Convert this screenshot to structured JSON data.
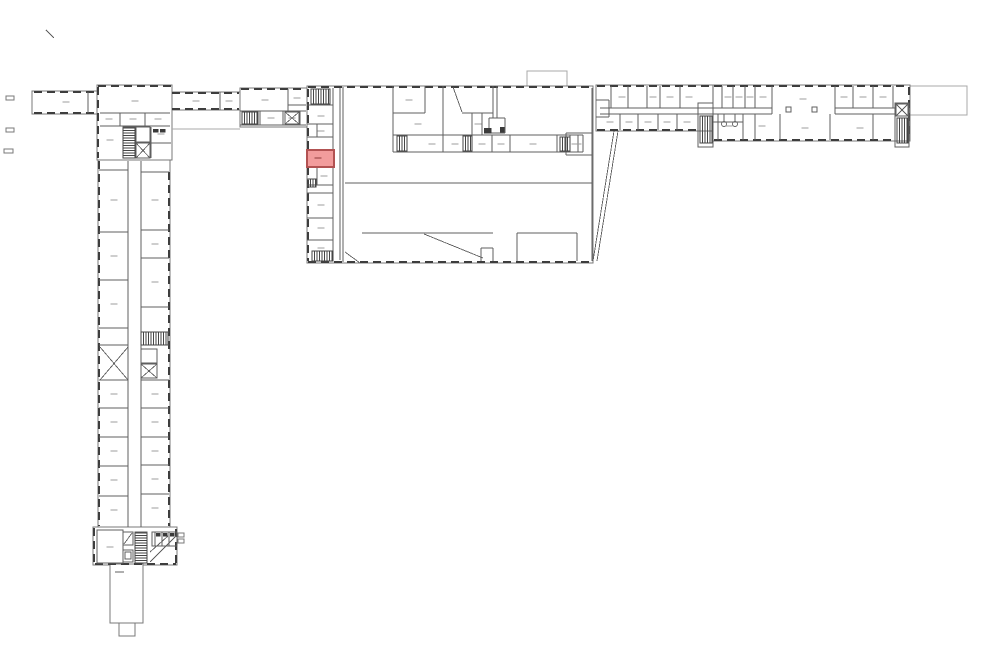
{
  "canvas": {
    "width": 1000,
    "height": 666,
    "background": "#ffffff"
  },
  "colors": {
    "envelope": "#787878",
    "wall": "#5f5f5f",
    "window": "#3d3d3d",
    "thin": "#a8a8a8",
    "hatch": "#454545",
    "label": "#9e9e9e",
    "dark": "#3a3a3a",
    "highlight_fill": "#F29C9C",
    "highlight_stroke": "#B25252",
    "highlight_label": "#8f3a3a"
  },
  "plan": {
    "envelopes": [
      [
        527,
        71,
        40,
        16,
        1
      ],
      [
        910,
        86,
        57,
        29,
        1
      ],
      [
        32,
        91,
        65,
        23,
        0
      ],
      [
        97,
        85,
        75,
        75,
        0
      ],
      [
        172,
        92,
        68,
        18,
        0
      ],
      [
        240,
        88,
        67,
        39,
        0
      ],
      [
        307,
        86,
        286,
        177,
        0
      ],
      [
        596,
        85,
        117,
        46,
        0
      ],
      [
        713,
        85,
        197,
        56,
        0
      ],
      [
        98,
        160,
        72,
        368,
        0
      ],
      [
        93,
        527,
        84,
        38,
        0
      ],
      [
        110,
        564,
        33,
        59,
        2
      ],
      [
        119,
        623,
        16,
        13,
        2
      ]
    ],
    "windows": [
      [
        34,
        92,
        95,
        92
      ],
      [
        34,
        113,
        95,
        113
      ],
      [
        98,
        87,
        98,
        158
      ],
      [
        98,
        86,
        171,
        86
      ],
      [
        172,
        93,
        239,
        93
      ],
      [
        172,
        109,
        239,
        109
      ],
      [
        241,
        89,
        306,
        89
      ],
      [
        308,
        87,
        592,
        87
      ],
      [
        308,
        262,
        592,
        262
      ],
      [
        308,
        89,
        308,
        261
      ],
      [
        597,
        86,
        909,
        86
      ],
      [
        597,
        130,
        697,
        130
      ],
      [
        714,
        140,
        894,
        140
      ],
      [
        909,
        87,
        909,
        139
      ],
      [
        99,
        161,
        99,
        526
      ],
      [
        169,
        172,
        169,
        526
      ],
      [
        94,
        528,
        94,
        564
      ],
      [
        95,
        564,
        176,
        564
      ],
      [
        176,
        529,
        176,
        563
      ]
    ],
    "walls": [
      [
        88,
        92,
        88,
        113
      ],
      [
        100,
        113,
        170,
        113
      ],
      [
        100,
        126,
        170,
        126
      ],
      [
        120,
        113,
        120,
        126
      ],
      [
        145,
        113,
        145,
        126
      ],
      [
        151,
        127,
        151,
        158
      ],
      [
        151,
        143,
        171,
        143
      ],
      [
        220,
        92,
        220,
        110
      ],
      [
        240,
        111,
        306,
        111
      ],
      [
        288,
        89,
        288,
        111
      ],
      [
        288,
        105,
        306,
        105
      ],
      [
        240,
        125,
        306,
        125
      ],
      [
        260,
        111,
        260,
        125
      ],
      [
        283,
        111,
        283,
        125
      ],
      [
        300,
        111,
        300,
        125
      ],
      [
        333,
        88,
        333,
        260
      ],
      [
        340,
        88,
        340,
        260
      ],
      [
        343,
        87,
        343,
        262
      ],
      [
        307,
        105,
        333,
        105
      ],
      [
        307,
        124,
        333,
        124
      ],
      [
        307,
        137,
        333,
        137
      ],
      [
        307,
        185,
        333,
        185
      ],
      [
        307,
        193,
        333,
        193
      ],
      [
        307,
        218,
        333,
        218
      ],
      [
        307,
        240,
        333,
        240
      ],
      [
        317,
        124,
        317,
        137
      ],
      [
        317,
        167,
        317,
        185
      ],
      [
        393,
        86,
        393,
        152
      ],
      [
        393,
        113,
        425,
        113
      ],
      [
        425,
        86,
        425,
        113
      ],
      [
        443,
        86,
        443,
        135
      ],
      [
        393,
        135,
        583,
        135
      ],
      [
        393,
        152,
        583,
        152
      ],
      [
        583,
        135,
        583,
        152
      ],
      [
        407,
        135,
        407,
        152
      ],
      [
        443,
        135,
        443,
        152
      ],
      [
        463,
        135,
        463,
        152
      ],
      [
        472,
        135,
        472,
        152
      ],
      [
        492,
        135,
        492,
        152
      ],
      [
        510,
        135,
        510,
        152
      ],
      [
        557,
        135,
        557,
        152
      ],
      [
        570,
        135,
        570,
        152
      ],
      [
        578,
        135,
        578,
        152
      ],
      [
        462,
        113,
        493,
        113
      ],
      [
        472,
        113,
        472,
        135
      ],
      [
        482,
        113,
        482,
        135
      ],
      [
        493,
        86,
        493,
        118
      ],
      [
        497,
        86,
        497,
        118
      ],
      [
        489,
        118,
        505,
        118
      ],
      [
        489,
        118,
        489,
        133
      ],
      [
        505,
        118,
        505,
        133
      ],
      [
        489,
        133,
        505,
        133
      ],
      [
        345,
        183,
        592,
        183
      ],
      [
        566,
        133,
        592,
        133
      ],
      [
        566,
        133,
        566,
        155
      ],
      [
        566,
        155,
        592,
        155
      ],
      [
        592,
        88,
        592,
        261
      ],
      [
        362,
        233,
        493,
        233
      ],
      [
        517,
        233,
        577,
        233
      ],
      [
        517,
        233,
        517,
        261
      ],
      [
        577,
        233,
        577,
        261
      ],
      [
        481,
        248,
        493,
        248
      ],
      [
        481,
        248,
        481,
        261
      ],
      [
        493,
        248,
        493,
        261
      ],
      [
        600,
        108,
        772,
        108
      ],
      [
        600,
        114,
        772,
        114
      ],
      [
        835,
        108,
        895,
        108
      ],
      [
        835,
        114,
        895,
        114
      ],
      [
        611,
        86,
        611,
        108
      ],
      [
        628,
        86,
        628,
        108
      ],
      [
        647,
        86,
        647,
        108
      ],
      [
        660,
        86,
        660,
        108
      ],
      [
        680,
        86,
        680,
        108
      ],
      [
        713,
        86,
        713,
        108
      ],
      [
        722,
        86,
        722,
        108
      ],
      [
        733,
        86,
        733,
        108
      ],
      [
        745,
        86,
        745,
        108
      ],
      [
        755,
        86,
        755,
        108
      ],
      [
        772,
        86,
        772,
        114
      ],
      [
        835,
        86,
        835,
        114
      ],
      [
        853,
        86,
        853,
        108
      ],
      [
        873,
        86,
        873,
        108
      ],
      [
        893,
        86,
        893,
        108
      ],
      [
        620,
        114,
        620,
        130
      ],
      [
        638,
        114,
        638,
        130
      ],
      [
        658,
        114,
        658,
        130
      ],
      [
        677,
        114,
        677,
        130
      ],
      [
        718,
        114,
        718,
        140
      ],
      [
        743,
        114,
        743,
        140
      ],
      [
        755,
        114,
        755,
        140
      ],
      [
        780,
        114,
        780,
        140
      ],
      [
        830,
        114,
        830,
        140
      ],
      [
        873,
        114,
        873,
        140
      ],
      [
        596,
        100,
        609,
        100
      ],
      [
        609,
        100,
        609,
        117
      ],
      [
        596,
        117,
        609,
        117
      ],
      [
        724,
        114,
        724,
        122
      ],
      [
        735,
        114,
        735,
        122
      ],
      [
        713,
        122,
        743,
        122
      ],
      [
        128,
        161,
        128,
        527
      ],
      [
        141,
        161,
        141,
        527
      ],
      [
        99,
        170,
        128,
        170
      ],
      [
        99,
        232,
        128,
        232
      ],
      [
        99,
        280,
        128,
        280
      ],
      [
        99,
        328,
        128,
        328
      ],
      [
        99,
        345,
        128,
        345
      ],
      [
        99,
        380,
        128,
        380
      ],
      [
        99,
        408,
        128,
        408
      ],
      [
        99,
        437,
        128,
        437
      ],
      [
        99,
        466,
        128,
        466
      ],
      [
        99,
        496,
        128,
        496
      ],
      [
        141,
        172,
        169,
        172
      ],
      [
        141,
        230,
        169,
        230
      ],
      [
        141,
        258,
        169,
        258
      ],
      [
        141,
        307,
        169,
        307
      ],
      [
        141,
        332,
        169,
        332
      ],
      [
        141,
        345,
        169,
        345
      ],
      [
        141,
        380,
        169,
        380
      ],
      [
        141,
        408,
        169,
        408
      ],
      [
        141,
        437,
        169,
        437
      ],
      [
        141,
        465,
        169,
        465
      ],
      [
        141,
        494,
        169,
        494
      ],
      [
        155,
        532,
        155,
        546
      ],
      [
        162,
        532,
        162,
        546
      ],
      [
        169,
        532,
        169,
        546
      ],
      [
        152,
        546,
        177,
        546
      ],
      [
        115,
        572,
        124,
        572
      ]
    ],
    "thin": [
      [
        172,
        129,
        240,
        129
      ]
    ],
    "boxes": [
      [
        123,
        127,
        12,
        31
      ],
      [
        136,
        127,
        14,
        15
      ],
      [
        97,
        530,
        26,
        33
      ],
      [
        123,
        532,
        10,
        13
      ],
      [
        123,
        550,
        10,
        12
      ],
      [
        125,
        552,
        6,
        7
      ],
      [
        135,
        532,
        12,
        31
      ],
      [
        152,
        532,
        25,
        14
      ],
      [
        786,
        107,
        5,
        5
      ],
      [
        812,
        107,
        5,
        5
      ],
      [
        141,
        349,
        16,
        14
      ],
      [
        698,
        103,
        15,
        44
      ],
      [
        895,
        103,
        14,
        44
      ]
    ],
    "hatches": [
      [
        123,
        128,
        12,
        30,
        "h"
      ],
      [
        242,
        112,
        16,
        12,
        "v"
      ],
      [
        311,
        89,
        19,
        15,
        "v"
      ],
      [
        308,
        179,
        8,
        8,
        "v"
      ],
      [
        312,
        251,
        21,
        10,
        "v"
      ],
      [
        397,
        136,
        10,
        15,
        "v"
      ],
      [
        463,
        136,
        9,
        15,
        "v"
      ],
      [
        560,
        137,
        10,
        14,
        "v"
      ],
      [
        700,
        116,
        12,
        27,
        "v"
      ],
      [
        897,
        118,
        11,
        25,
        "v"
      ],
      [
        141,
        332,
        27,
        13,
        "v"
      ],
      [
        135,
        533,
        12,
        30,
        "h"
      ]
    ],
    "xboxes": [
      [
        136,
        143,
        14,
        15
      ],
      [
        285,
        112,
        14,
        12
      ],
      [
        896,
        104,
        12,
        12
      ],
      [
        141,
        364,
        16,
        14
      ]
    ],
    "diagonals": [
      [
        424,
        234,
        483,
        258
      ],
      [
        345,
        252,
        360,
        263
      ],
      [
        614,
        131,
        593,
        261
      ],
      [
        618,
        131,
        597,
        261
      ],
      [
        453,
        87,
        462,
        112
      ],
      [
        100,
        347,
        128,
        380
      ],
      [
        128,
        347,
        100,
        380
      ],
      [
        124,
        544,
        132,
        533
      ],
      [
        150,
        562,
        176,
        536
      ],
      [
        150,
        552,
        168,
        536
      ],
      [
        46,
        30,
        54,
        38
      ]
    ],
    "darks": [
      [
        500,
        127,
        4,
        5
      ],
      [
        484,
        128,
        7,
        5
      ],
      [
        156,
        533,
        4,
        3
      ],
      [
        163,
        533,
        4,
        3
      ],
      [
        170,
        533,
        4,
        3
      ],
      [
        153,
        129,
        5,
        3
      ],
      [
        160,
        129,
        5,
        3
      ]
    ],
    "circles": [
      [
        724,
        124,
        2.5
      ],
      [
        735,
        124,
        2.5
      ]
    ],
    "marks": [
      [
        6,
        96,
        8,
        4
      ],
      [
        6,
        128,
        8,
        4
      ],
      [
        4,
        149,
        9,
        4
      ],
      [
        178,
        533,
        6,
        4
      ],
      [
        178,
        539,
        6,
        4
      ]
    ],
    "labels": [
      [
        66,
        102
      ],
      [
        135,
        101
      ],
      [
        109,
        119
      ],
      [
        133,
        119
      ],
      [
        158,
        119
      ],
      [
        110,
        140
      ],
      [
        161,
        134
      ],
      [
        196,
        101
      ],
      [
        229,
        101
      ],
      [
        265,
        100
      ],
      [
        297,
        98
      ],
      [
        271,
        118
      ],
      [
        292,
        118
      ],
      [
        321,
        116
      ],
      [
        321,
        131
      ],
      [
        324,
        176
      ],
      [
        321,
        205
      ],
      [
        321,
        228
      ],
      [
        321,
        248
      ],
      [
        409,
        100
      ],
      [
        418,
        124
      ],
      [
        478,
        124
      ],
      [
        432,
        144
      ],
      [
        455,
        144
      ],
      [
        482,
        144
      ],
      [
        501,
        144
      ],
      [
        533,
        144
      ],
      [
        575,
        144
      ],
      [
        578,
        144
      ],
      [
        622,
        97
      ],
      [
        653,
        97
      ],
      [
        670,
        97
      ],
      [
        689,
        97
      ],
      [
        728,
        97
      ],
      [
        739,
        97
      ],
      [
        750,
        97
      ],
      [
        763,
        97
      ],
      [
        803,
        99
      ],
      [
        844,
        97
      ],
      [
        863,
        97
      ],
      [
        883,
        97
      ],
      [
        610,
        122
      ],
      [
        629,
        122
      ],
      [
        648,
        122
      ],
      [
        667,
        122
      ],
      [
        687,
        122
      ],
      [
        729,
        126
      ],
      [
        762,
        126
      ],
      [
        805,
        128
      ],
      [
        860,
        128
      ],
      [
        114,
        200
      ],
      [
        114,
        256
      ],
      [
        114,
        304
      ],
      [
        114,
        394
      ],
      [
        114,
        422
      ],
      [
        114,
        451
      ],
      [
        114,
        480
      ],
      [
        114,
        510
      ],
      [
        155,
        200
      ],
      [
        155,
        244
      ],
      [
        155,
        282
      ],
      [
        155,
        394
      ],
      [
        155,
        422
      ],
      [
        155,
        451
      ],
      [
        155,
        479
      ],
      [
        155,
        508
      ],
      [
        110,
        547
      ]
    ],
    "highlight": {
      "x": 307,
      "y": 150,
      "w": 27,
      "h": 17,
      "label_x": 318,
      "label_y": 158
    }
  }
}
